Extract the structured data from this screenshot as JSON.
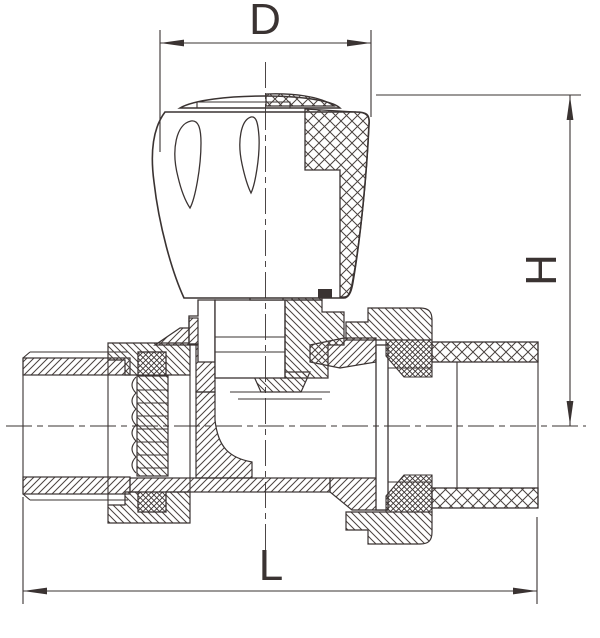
{
  "drawing": {
    "kind": "valve cross-section technical drawing"
  },
  "labels": {
    "width_dim": "D",
    "height_dim": "H",
    "length_dim": "L"
  },
  "colors": {
    "line": "#3a3332",
    "background": "#ffffff"
  }
}
